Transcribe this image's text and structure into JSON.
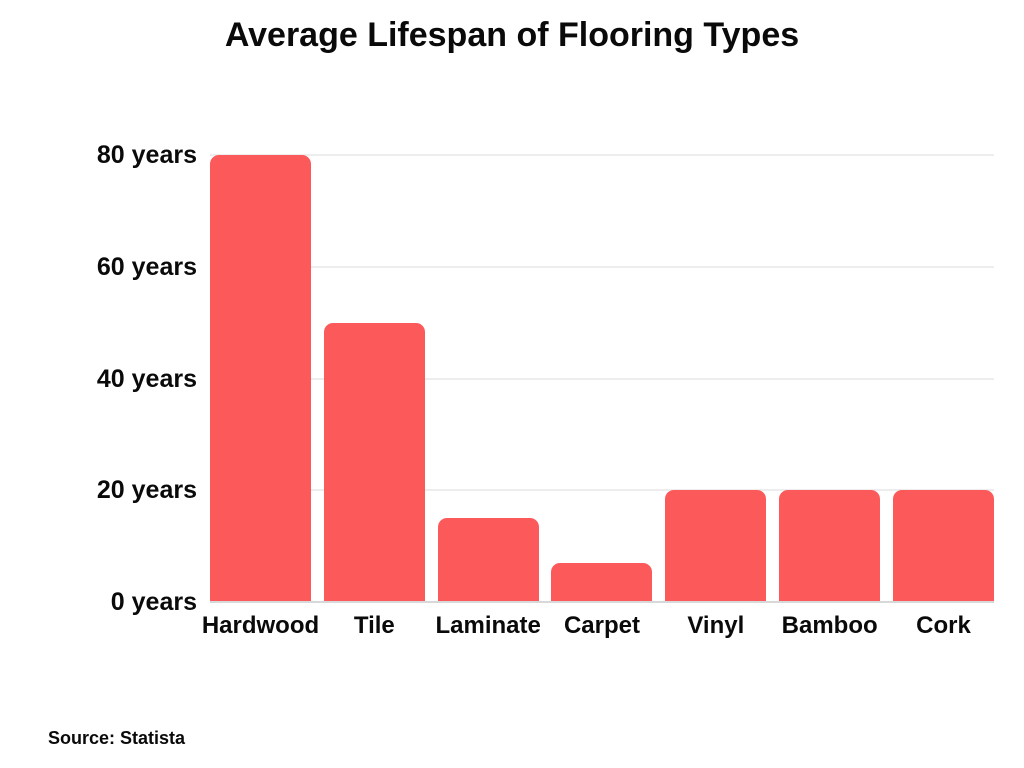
{
  "chart_data": {
    "type": "bar",
    "title": "Average Lifespan of Flooring Types",
    "categories": [
      "Hardwood",
      "Tile",
      "Laminate",
      "Carpet",
      "Vinyl",
      "Bamboo",
      "Cork"
    ],
    "values": [
      80,
      50,
      15,
      7,
      20,
      20,
      20
    ],
    "unit": "years",
    "xlabel": "",
    "ylabel": "",
    "ylim": [
      0,
      80
    ],
    "yticks": [
      0,
      20,
      40,
      60,
      80
    ],
    "ytick_labels": [
      "0 years",
      "20 years",
      "40 years",
      "60 years",
      "80 years"
    ],
    "grid": "horizontal",
    "legend": "none",
    "bar_color": "#FC5A5A",
    "gridline_color": "#EDEDED",
    "baseline_color": "#D8D8D8",
    "text_color": "#0A0A0A",
    "background_color": "#FFFFFF"
  },
  "footer": {
    "source_label": "Source: Statista"
  }
}
